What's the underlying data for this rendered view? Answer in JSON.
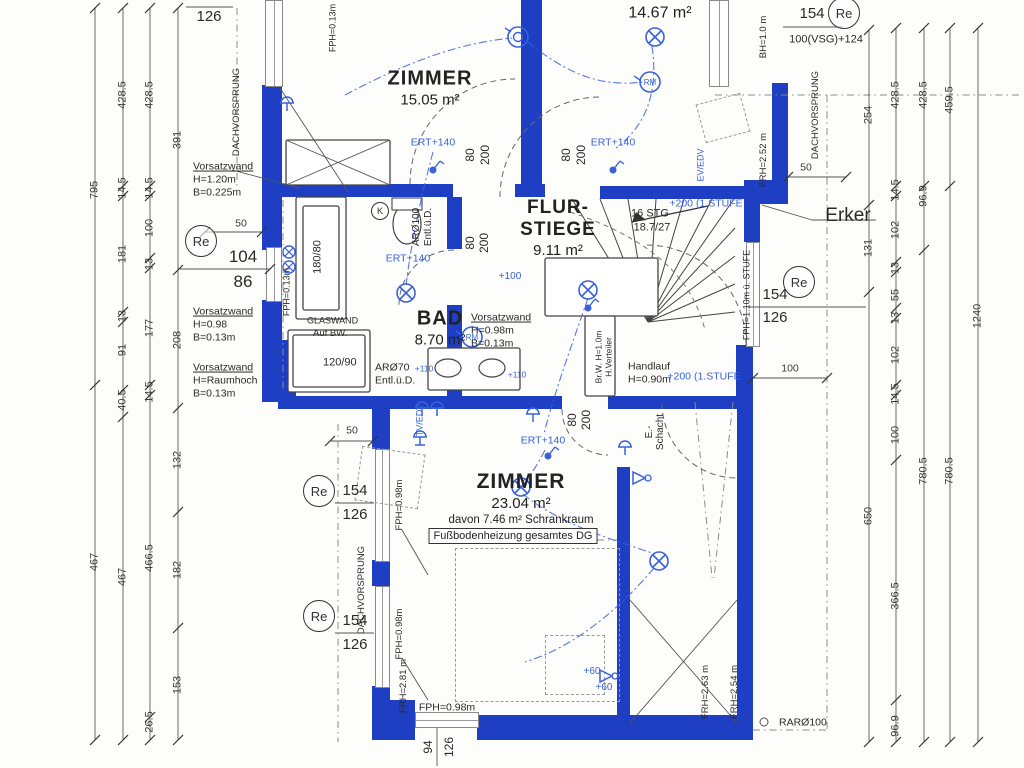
{
  "plan": {
    "title": "Obergeschoss Grundriss (Bauplan-Scan)",
    "colors": {
      "wall": "#1e3fc4",
      "electric": "#3a62d8",
      "ink": "#2a2a2a"
    },
    "rooms": [
      {
        "name": "ZIMMER",
        "area": "15.05 m²"
      },
      {
        "name": "",
        "area": "14.67 m²"
      },
      {
        "name_l1": "FLUR-",
        "name_l2": "STIEGE",
        "area": "9.11 m²"
      },
      {
        "name": "BAD",
        "area": "8.70 m²"
      },
      {
        "name": "ZIMMER",
        "area": "23.04 m²",
        "detail": "davon 7.46 m² Schrankraum",
        "note": "Fußbodenheizung gesamtes DG"
      }
    ],
    "markers": [
      {
        "label": "Re",
        "x": 200,
        "y": 240,
        "r": 15
      },
      {
        "label": "Re",
        "x": 318,
        "y": 490,
        "r": 15
      },
      {
        "label": "Re",
        "x": 318,
        "y": 615,
        "r": 15
      },
      {
        "label": "Re",
        "x": 798,
        "y": 281,
        "r": 15
      },
      {
        "label": "Re",
        "x": 843,
        "y": 12,
        "r": 15
      },
      {
        "label": "K",
        "x": 379,
        "y": 210,
        "r": 8
      }
    ],
    "labels": [
      {
        "t": "795",
        "x": 95,
        "y": 190,
        "r": -90,
        "c": "d"
      },
      {
        "t": "467",
        "x": 95,
        "y": 562,
        "r": -90,
        "c": "d"
      },
      {
        "t": "428.5",
        "x": 123,
        "y": 95,
        "r": -90,
        "c": "d"
      },
      {
        "t": "14.5",
        "x": 123,
        "y": 188,
        "r": -90,
        "c": "d"
      },
      {
        "t": "181",
        "x": 123,
        "y": 254,
        "r": -90,
        "c": "d"
      },
      {
        "t": "13",
        "x": 123,
        "y": 316,
        "r": -90,
        "c": "d"
      },
      {
        "t": "91",
        "x": 123,
        "y": 350,
        "r": -90,
        "c": "d"
      },
      {
        "t": "40.5",
        "x": 123,
        "y": 400,
        "r": -90,
        "c": "d"
      },
      {
        "t": "467",
        "x": 123,
        "y": 577,
        "r": -90,
        "c": "d"
      },
      {
        "t": "428.5",
        "x": 150,
        "y": 95,
        "r": -90,
        "c": "d"
      },
      {
        "t": "14.5",
        "x": 150,
        "y": 188,
        "r": -90,
        "c": "d"
      },
      {
        "t": "100",
        "x": 150,
        "y": 228,
        "r": -90,
        "c": "d"
      },
      {
        "t": "13",
        "x": 150,
        "y": 264,
        "r": -90,
        "c": "d"
      },
      {
        "t": "177",
        "x": 150,
        "y": 328,
        "r": -90,
        "c": "d"
      },
      {
        "t": "14.5",
        "x": 150,
        "y": 392,
        "r": -90,
        "c": "d"
      },
      {
        "t": "466.5",
        "x": 150,
        "y": 558,
        "r": -90,
        "c": "d"
      },
      {
        "t": "26.5",
        "x": 150,
        "y": 722,
        "r": -90,
        "c": "d"
      },
      {
        "t": "391",
        "x": 178,
        "y": 140,
        "r": -90,
        "c": "d"
      },
      {
        "t": "208",
        "x": 178,
        "y": 340,
        "r": -90,
        "c": "d"
      },
      {
        "t": "132",
        "x": 178,
        "y": 460,
        "r": -90,
        "c": "d"
      },
      {
        "t": "182",
        "x": 178,
        "y": 570,
        "r": -90,
        "c": "d"
      },
      {
        "t": "153",
        "x": 178,
        "y": 685,
        "r": -90,
        "c": "d"
      },
      {
        "t": "254",
        "x": 869,
        "y": 115,
        "r": -90,
        "c": "d"
      },
      {
        "t": "131",
        "x": 869,
        "y": 248,
        "r": -90,
        "c": "d"
      },
      {
        "t": "650",
        "x": 869,
        "y": 516,
        "r": -90,
        "c": "d"
      },
      {
        "t": "428.5",
        "x": 896,
        "y": 95,
        "r": -90,
        "c": "d"
      },
      {
        "t": "14.5",
        "x": 896,
        "y": 190,
        "r": -90,
        "c": "d"
      },
      {
        "t": "102",
        "x": 896,
        "y": 230,
        "r": -90,
        "c": "d"
      },
      {
        "t": "13",
        "x": 896,
        "y": 268,
        "r": -90,
        "c": "d"
      },
      {
        "t": "55",
        "x": 896,
        "y": 295,
        "r": -90,
        "c": "d"
      },
      {
        "t": "13",
        "x": 896,
        "y": 318,
        "r": -90,
        "c": "d"
      },
      {
        "t": "102",
        "x": 896,
        "y": 355,
        "r": -90,
        "c": "d"
      },
      {
        "t": "14.5",
        "x": 896,
        "y": 394,
        "r": -90,
        "c": "d"
      },
      {
        "t": "100",
        "x": 896,
        "y": 435,
        "r": -90,
        "c": "d"
      },
      {
        "t": "366.5",
        "x": 896,
        "y": 596,
        "r": -90,
        "c": "d"
      },
      {
        "t": "96.9",
        "x": 896,
        "y": 726,
        "r": -90,
        "c": "d"
      },
      {
        "t": "428.5",
        "x": 924,
        "y": 95,
        "r": -90,
        "c": "d"
      },
      {
        "t": "96.9",
        "x": 924,
        "y": 196,
        "r": -90,
        "c": "d"
      },
      {
        "t": "780.5",
        "x": 924,
        "y": 471,
        "r": -90,
        "c": "d"
      },
      {
        "t": "459.5",
        "x": 950,
        "y": 100,
        "r": -90,
        "c": "d"
      },
      {
        "t": "780.5",
        "x": 950,
        "y": 471,
        "r": -90,
        "c": "d"
      },
      {
        "t": "1240",
        "x": 978,
        "y": 316,
        "r": -90,
        "c": "d"
      },
      {
        "t": "50",
        "x": 241,
        "y": 224,
        "s": 10.5,
        "c": "d"
      },
      {
        "t": "50",
        "x": 352,
        "y": 431,
        "s": 10.5,
        "c": "d"
      },
      {
        "t": "50",
        "x": 806,
        "y": 168,
        "s": 10.5,
        "c": "d"
      },
      {
        "t": "100",
        "x": 790,
        "y": 369,
        "s": 10.5,
        "c": "d"
      },
      {
        "t": "104",
        "x": 243,
        "y": 257,
        "s": 17
      },
      {
        "t": "86",
        "x": 243,
        "y": 282,
        "s": 17
      },
      {
        "t": "154",
        "x": 355,
        "y": 491,
        "s": 15
      },
      {
        "t": "126",
        "x": 355,
        "y": 515,
        "s": 15
      },
      {
        "t": "154",
        "x": 355,
        "y": 621,
        "s": 15
      },
      {
        "t": "126",
        "x": 355,
        "y": 645,
        "s": 15
      },
      {
        "t": "154",
        "x": 775,
        "y": 295,
        "s": 15
      },
      {
        "t": "126",
        "x": 775,
        "y": 318,
        "s": 15
      },
      {
        "t": "154",
        "x": 812,
        "y": 14,
        "s": 15
      },
      {
        "t": "100(VSG)+124",
        "x": 826,
        "y": 40,
        "s": 11
      },
      {
        "t": "254",
        "x": 209,
        "y": -4,
        "s": 15
      },
      {
        "t": "126",
        "x": 209,
        "y": 17,
        "s": 15
      },
      {
        "t": "94",
        "x": 428,
        "y": 747,
        "r": -90,
        "s": 12
      },
      {
        "t": "126",
        "x": 449,
        "y": 747,
        "r": -90,
        "s": 12
      },
      {
        "t": "80",
        "x": 470,
        "y": 155,
        "r": -90,
        "s": 12
      },
      {
        "t": "200",
        "x": 485,
        "y": 155,
        "r": -90,
        "s": 12
      },
      {
        "t": "80",
        "x": 566,
        "y": 155,
        "r": -90,
        "s": 12
      },
      {
        "t": "200",
        "x": 581,
        "y": 155,
        "r": -90,
        "s": 12
      },
      {
        "t": "80",
        "x": 470,
        "y": 243,
        "r": -90,
        "s": 12
      },
      {
        "t": "200",
        "x": 484,
        "y": 243,
        "r": -90,
        "s": 12
      },
      {
        "t": "80",
        "x": 572,
        "y": 420,
        "r": -90,
        "s": 12
      },
      {
        "t": "200",
        "x": 586,
        "y": 420,
        "r": -90,
        "s": 12
      },
      {
        "t": "Vorsatzwand",
        "x": 193,
        "y": 167,
        "s": 10.5,
        "a": "l",
        "u": 1
      },
      {
        "t": "H=1.20m",
        "x": 193,
        "y": 180,
        "s": 10.5,
        "a": "l"
      },
      {
        "t": "B=0.225m",
        "x": 193,
        "y": 193,
        "s": 10.5,
        "a": "l"
      },
      {
        "t": "Vorsatzwand",
        "x": 193,
        "y": 312,
        "s": 10.5,
        "a": "l",
        "u": 1
      },
      {
        "t": "H=0.98",
        "x": 193,
        "y": 325,
        "s": 10.5,
        "a": "l"
      },
      {
        "t": "B=0.13m",
        "x": 193,
        "y": 338,
        "s": 10.5,
        "a": "l"
      },
      {
        "t": "Vorsatzwand",
        "x": 193,
        "y": 368,
        "s": 10.5,
        "a": "l",
        "u": 1
      },
      {
        "t": "H=Raumhoch",
        "x": 193,
        "y": 381,
        "s": 10.5,
        "a": "l"
      },
      {
        "t": "B=0.13m",
        "x": 193,
        "y": 394,
        "s": 10.5,
        "a": "l"
      },
      {
        "t": "Vorsatzwand",
        "x": 471,
        "y": 318,
        "s": 10.5,
        "a": "l",
        "u": 1
      },
      {
        "t": "H=0.98m",
        "x": 471,
        "y": 331,
        "s": 10.5,
        "a": "l"
      },
      {
        "t": "B=0.13m",
        "x": 471,
        "y": 344,
        "s": 10.5,
        "a": "l"
      },
      {
        "t": "GLASWAND",
        "x": 307,
        "y": 321,
        "s": 9,
        "a": "l"
      },
      {
        "t": "Auf BW.",
        "x": 313,
        "y": 334,
        "s": 9.5,
        "a": "l"
      },
      {
        "t": "120/90",
        "x": 323,
        "y": 363,
        "s": 11,
        "a": "l"
      },
      {
        "t": "180/80",
        "x": 318,
        "y": 257,
        "r": -90,
        "s": 11
      },
      {
        "t": "16 STG",
        "x": 650,
        "y": 214,
        "s": 11
      },
      {
        "t": "18.7/27",
        "x": 652,
        "y": 228,
        "s": 11
      },
      {
        "t": "Handlauf",
        "x": 628,
        "y": 367,
        "s": 10.5,
        "a": "l"
      },
      {
        "t": "H=0.90m",
        "x": 628,
        "y": 380,
        "s": 10.5,
        "a": "l"
      },
      {
        "t": "ARØ70",
        "x": 375,
        "y": 368,
        "s": 10.5,
        "a": "l"
      },
      {
        "t": "Entl.ü.D.",
        "x": 375,
        "y": 381,
        "s": 10.5,
        "a": "l"
      },
      {
        "t": "ARØ100",
        "x": 417,
        "y": 227,
        "r": -90,
        "s": 10
      },
      {
        "t": "Entl.ü.D.",
        "x": 429,
        "y": 227,
        "r": -90,
        "s": 10
      },
      {
        "t": "Erker",
        "x": 848,
        "y": 216,
        "s": 19
      },
      {
        "t": "RARØ100",
        "x": 779,
        "y": 723,
        "s": 10.5,
        "a": "l"
      },
      {
        "t": "DACHVORSPRUNG",
        "x": 237,
        "y": 112,
        "r": -90,
        "s": 9.5
      },
      {
        "t": "DACHVORSPRUNG",
        "x": 816,
        "y": 115,
        "r": -90,
        "s": 9.5
      },
      {
        "t": "DACHVORSPRUNG",
        "x": 362,
        "y": 590,
        "r": -90,
        "s": 9.5
      },
      {
        "t": "BH=1.0 m",
        "x": 764,
        "y": 37,
        "r": -90,
        "s": 9.5
      },
      {
        "t": "FRH=2.52 m",
        "x": 764,
        "y": 160,
        "r": -90,
        "s": 9.5
      },
      {
        "t": "FPH=1.10m ü. STUFE",
        "x": 747,
        "y": 295,
        "r": -90,
        "s": 9
      },
      {
        "t": "Br.W. H=1.0m",
        "x": 599,
        "y": 357,
        "r": -90,
        "s": 8.5
      },
      {
        "t": "H.Verteiler",
        "x": 609,
        "y": 357,
        "r": -90,
        "s": 8.5
      },
      {
        "t": "E.-",
        "x": 650,
        "y": 432,
        "r": -90,
        "s": 10
      },
      {
        "t": "Schacht",
        "x": 661,
        "y": 432,
        "r": -90,
        "s": 10
      },
      {
        "t": "FPH=0.98m",
        "x": 400,
        "y": 505,
        "r": -90,
        "s": 9.5
      },
      {
        "t": "FPH=0.98m",
        "x": 400,
        "y": 634,
        "r": -90,
        "s": 9.5
      },
      {
        "t": "FPH=0.98m",
        "x": 447,
        "y": 708,
        "s": 10.5
      },
      {
        "t": "FRH=2.81 m",
        "x": 404,
        "y": 686,
        "r": -90,
        "s": 9.5
      },
      {
        "t": "FRH=2.63 m",
        "x": 706,
        "y": 692,
        "r": -90,
        "s": 9.5
      },
      {
        "t": "FRH=2.54 m",
        "x": 735,
        "y": 692,
        "r": -90,
        "s": 9.5
      },
      {
        "t": "FPH=0.13m",
        "x": 287,
        "y": 292,
        "r": -90,
        "s": 9
      },
      {
        "t": "FPH=0.13m",
        "x": 333,
        "y": 28,
        "r": -90,
        "s": 9
      },
      {
        "t": "ERT+140",
        "x": 433,
        "y": 143,
        "s": 10.5,
        "c": "b"
      },
      {
        "t": "ERT+140",
        "x": 613,
        "y": 143,
        "s": 10.5,
        "c": "b"
      },
      {
        "t": "ERT+140",
        "x": 408,
        "y": 259,
        "s": 10.5,
        "c": "b"
      },
      {
        "t": "ERT+140",
        "x": 543,
        "y": 441,
        "s": 10.5,
        "c": "b"
      },
      {
        "t": "+200 (1.STUFE",
        "x": 706,
        "y": 204,
        "s": 10.5,
        "c": "b"
      },
      {
        "t": "+200 (1.STUFE",
        "x": 704,
        "y": 377,
        "s": 10.5,
        "c": "b"
      },
      {
        "t": "+100",
        "x": 510,
        "y": 277,
        "s": 10,
        "c": "b"
      },
      {
        "t": "EV/EDV",
        "x": 701,
        "y": 165,
        "r": -90,
        "s": 9,
        "c": "b"
      },
      {
        "t": "TV/EDV",
        "x": 420,
        "y": 420,
        "r": -90,
        "s": 9,
        "c": "b"
      },
      {
        "t": "+60",
        "x": 592,
        "y": 672,
        "s": 10,
        "c": "b"
      },
      {
        "t": "+60",
        "x": 604,
        "y": 688,
        "s": 10,
        "c": "b"
      },
      {
        "t": "+110",
        "x": 424,
        "y": 369,
        "s": 8.5,
        "c": "b"
      },
      {
        "t": "+110",
        "x": 517,
        "y": 375,
        "s": 8.5,
        "c": "b"
      }
    ],
    "symbols": [
      {
        "type": "ceiling-lamp",
        "x": 655,
        "y": 37
      },
      {
        "type": "ceiling-lamp",
        "x": 406,
        "y": 293
      },
      {
        "type": "ceiling-lamp",
        "x": 588,
        "y": 290
      },
      {
        "type": "ceiling-lamp",
        "x": 521,
        "y": 487
      },
      {
        "type": "ceiling-lamp",
        "x": 659,
        "y": 561
      },
      {
        "type": "smoke-detector",
        "label": "RM",
        "x": 650,
        "y": 82
      },
      {
        "type": "smoke-detector",
        "label": "RM",
        "x": 472,
        "y": 337
      },
      {
        "type": "vent",
        "x": 518,
        "y": 37
      },
      {
        "type": "valve",
        "x": 289,
        "y": 252
      },
      {
        "type": "valve",
        "x": 289,
        "y": 267
      },
      {
        "type": "socket",
        "x": 287,
        "y": 103
      },
      {
        "type": "socket",
        "x": 422,
        "y": 408
      },
      {
        "type": "socket",
        "x": 437,
        "y": 408
      },
      {
        "type": "socket",
        "x": 533,
        "y": 414
      },
      {
        "type": "socket",
        "x": 625,
        "y": 447
      },
      {
        "type": "switch",
        "x": 433,
        "y": 170
      },
      {
        "type": "switch",
        "x": 613,
        "y": 170
      },
      {
        "type": "switch",
        "x": 548,
        "y": 456
      },
      {
        "type": "switch",
        "x": 588,
        "y": 308
      },
      {
        "type": "wall-light",
        "x": 640,
        "y": 478
      },
      {
        "type": "wall-light",
        "x": 607,
        "y": 676
      },
      {
        "type": "tv-outlet",
        "x": 420,
        "y": 437
      }
    ]
  }
}
